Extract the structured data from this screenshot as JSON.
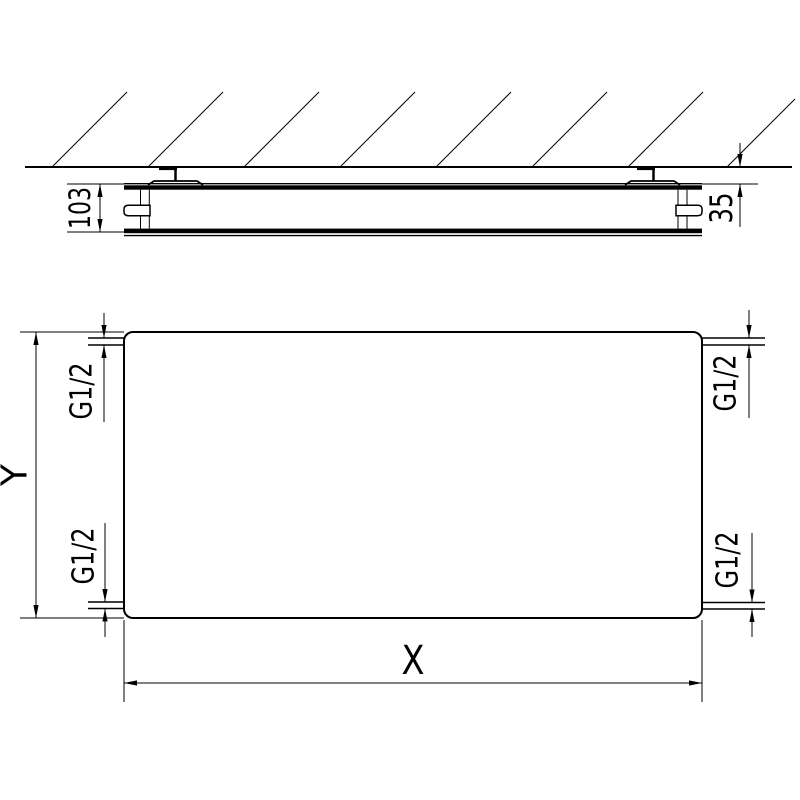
{
  "side_view": {
    "depth_dim_label": "103",
    "wall_clearance_dim_label": "35"
  },
  "front_view": {
    "width_dim_label": "X",
    "height_dim_label": "Y",
    "connections": {
      "top_left": "G1/2",
      "top_right": "G1/2",
      "bottom_left": "G1/2",
      "bottom_right": "G1/2"
    }
  },
  "colors": {
    "line": "#000000",
    "background": "#ffffff"
  }
}
